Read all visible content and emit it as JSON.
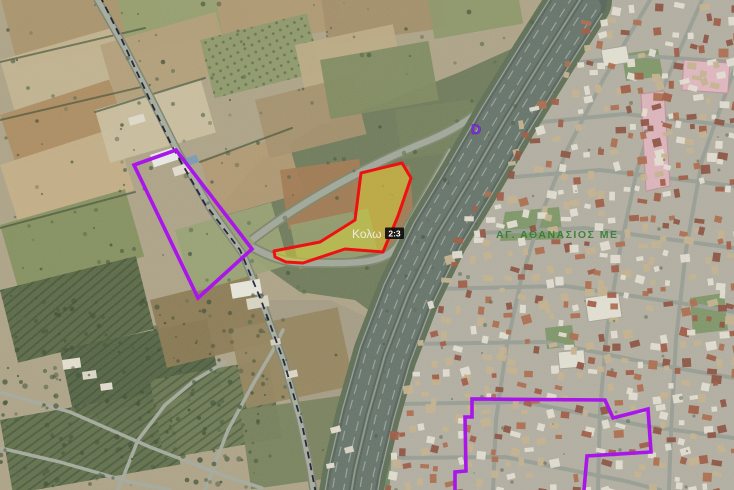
{
  "map": {
    "parcel_tag": {
      "name": "Κολω",
      "badge": "2:3"
    },
    "district_label": "ΑΓ. ΑΘΑΝΑΣΙΟΣ ΜΕ",
    "marker_glyph": "D",
    "colors": {
      "parcel_stroke": "#ee1111",
      "parcel_fill": "#d8d438",
      "boundary_purple": "#a816ea",
      "municipal_line": "#191930",
      "district_label": "#2d7a2d",
      "marker": "#8633d9",
      "badge_bg": "#0d0d0d",
      "badge_text": "#ffffff",
      "parcel_text": "#f3f0e6"
    },
    "overlays": {
      "selected_parcel_points": "402,163 411,178 398,216 383,252 345,249 303,263 286,262 275,257 274,251 320,242 344,227 355,220 361,173",
      "left_boundary_points": "134,165 176,150 252,249 198,298",
      "right_boundary_points": "455,490 455,472 466,471 465,417 472,417 472,399 605,400 613,418 648,409 651,452 587,456 584,490",
      "municipal_line_points": "100,-4 122,40 148,96 172,146 205,204 240,250 261,300 284,362 302,424 311,468 316,494"
    }
  }
}
